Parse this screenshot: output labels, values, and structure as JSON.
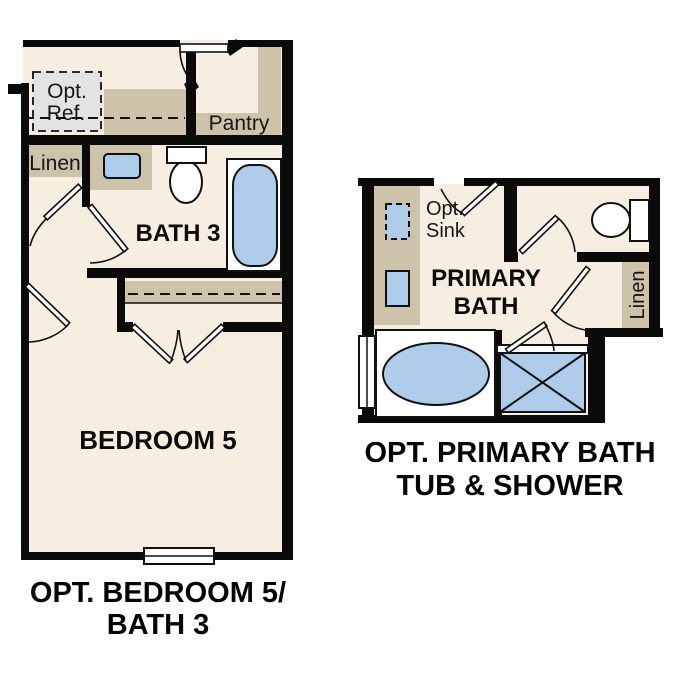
{
  "colors": {
    "background": "#ffffff",
    "wall": "#0a0a0a",
    "floor": "#f6eee1",
    "counter": "#cdc3ab",
    "fixture_blue": "#aecbea",
    "optional_grey": "#e3e3e3",
    "text": "#161616"
  },
  "left_plan": {
    "labels": {
      "opt_ref_line1": "Opt.",
      "opt_ref_line2": "Ref.",
      "pantry": "Pantry",
      "linen": "Linen",
      "bath": "BATH 3",
      "bedroom": "BEDROOM 5"
    },
    "caption_line1": "OPT. BEDROOM 5/",
    "caption_line2": "BATH 3"
  },
  "right_plan": {
    "labels": {
      "opt_sink_line1": "Opt.",
      "opt_sink_line2": "Sink",
      "primary_bath_line1": "PRIMARY",
      "primary_bath_line2": "BATH",
      "linen": "Linen"
    },
    "caption_line1": "OPT. PRIMARY BATH",
    "caption_line2": "TUB & SHOWER"
  }
}
